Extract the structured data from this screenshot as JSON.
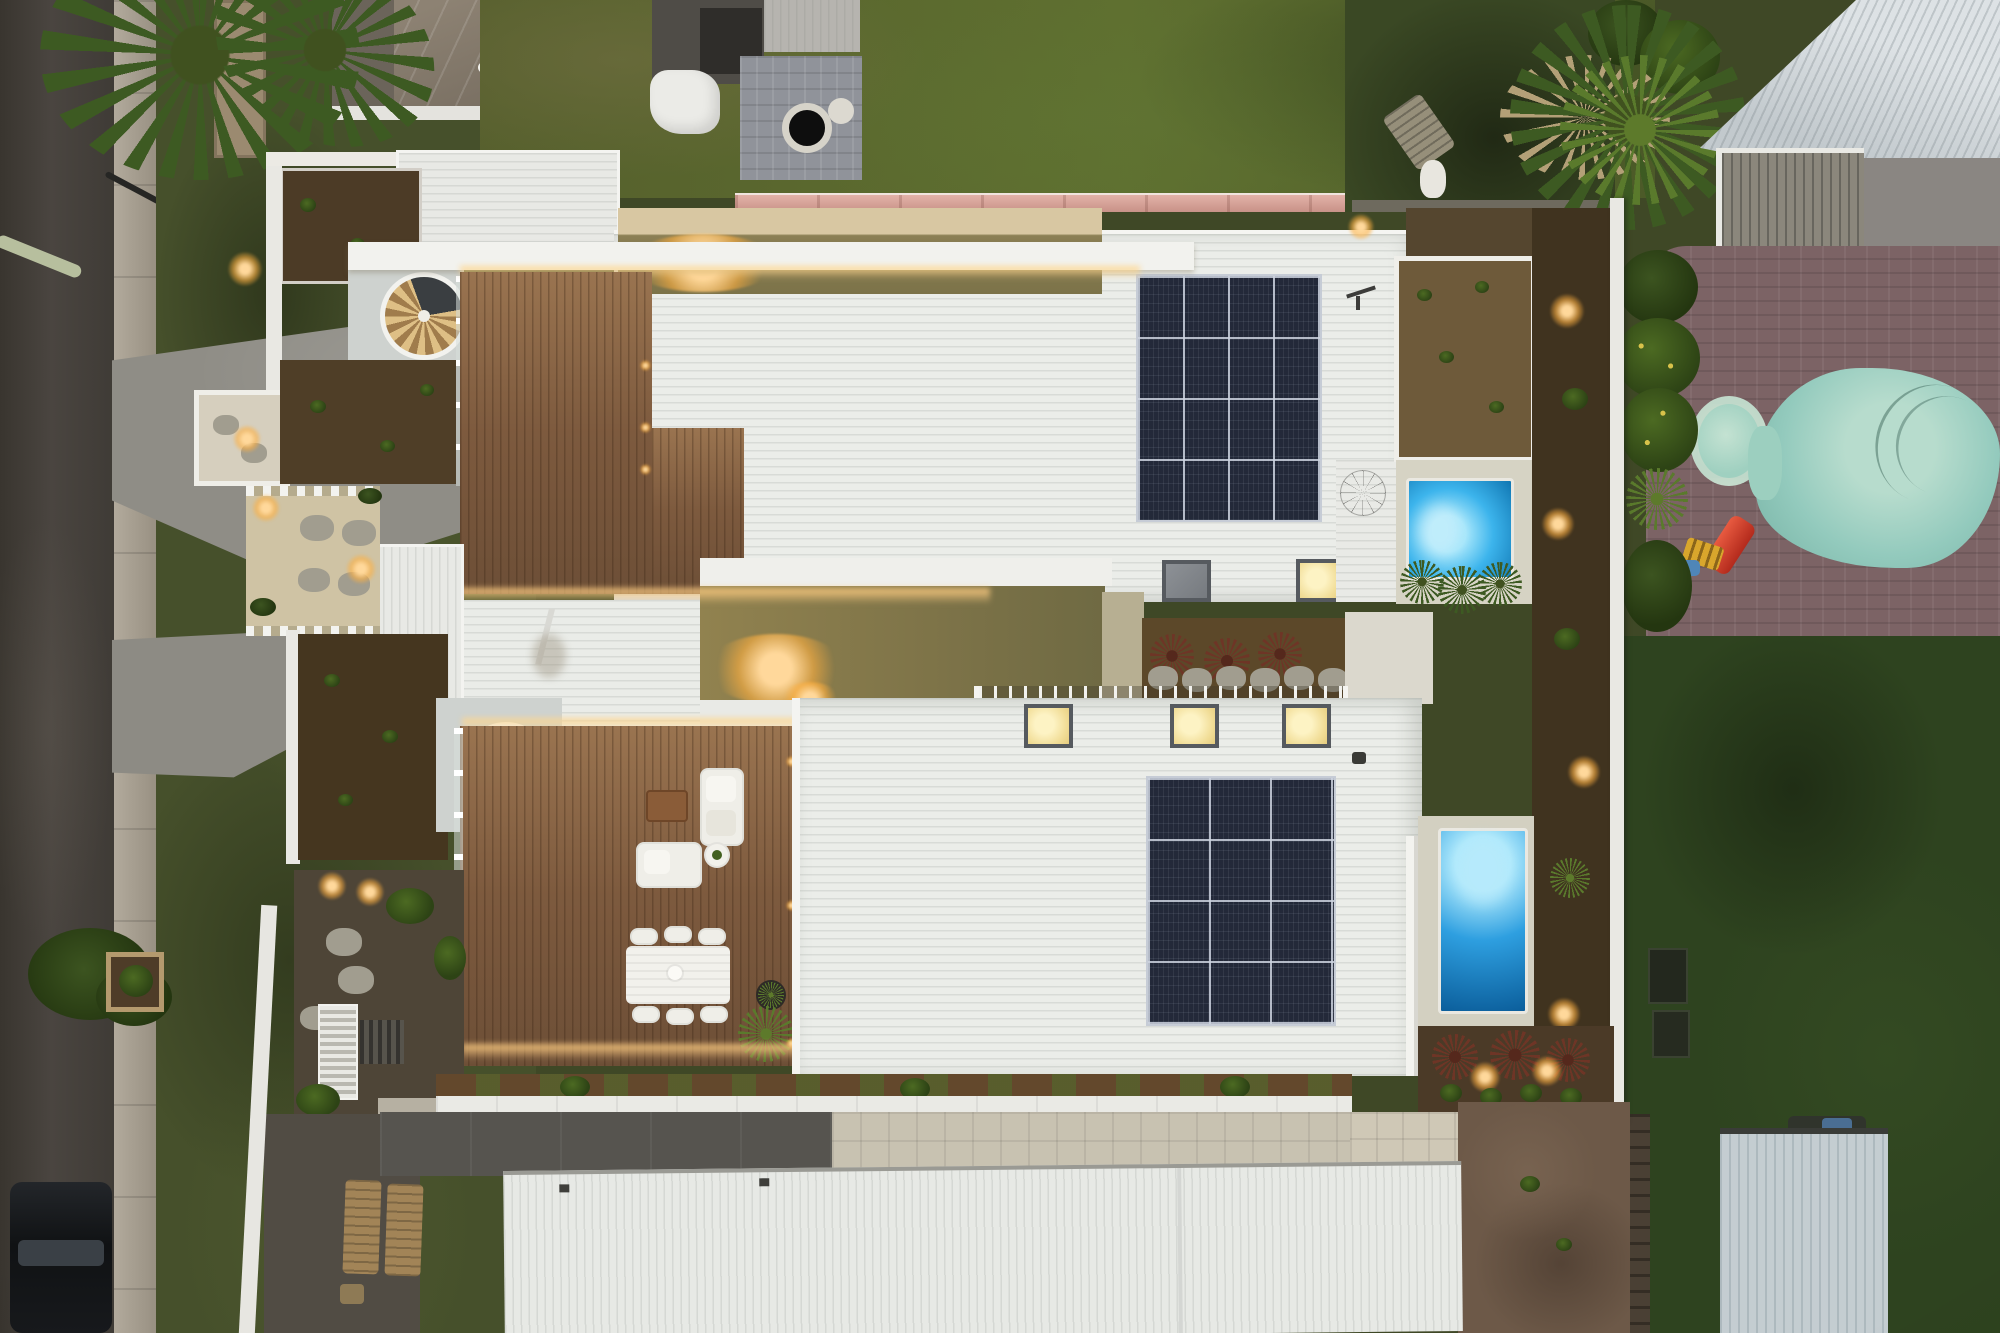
{
  "scene": {
    "type": "aerial-photograph",
    "setting": "top-down drone photo of a modern two-unit duplex at dusk",
    "time_of_day": "dusk with exterior lighting on",
    "no_visible_text": true,
    "title": "Aerial dusk view of duplex with rooftop decks, plunge pools and solar panels"
  },
  "palette": {
    "asphalt": "#45403a",
    "concrete": "#8f8d86",
    "grass_dark": "#3c4726",
    "grass_bright": "#5f7030",
    "roof_white": "#ebede9",
    "deck_timber": "#7e5b40",
    "mulch": "#4a3a26",
    "led_warm": "#ffc87e",
    "solar_navy": "#232939",
    "pool_blue": "#2aa0e2",
    "neighbor_pool_teal": "#93cabd",
    "fence_pink": "#d8a79e"
  },
  "street": {
    "road": "asphalt street along the left edge",
    "curb": "concrete kerb strip",
    "parked_car": "black SUV parked at the kerb, bottom left",
    "street_lamp": "lamp arm over the verge",
    "driveway_count": 2
  },
  "duplex": {
    "description": "two mirrored units, white metal roofs, rooftop timber decks, spiral stairs, plunge pools, solar arrays",
    "unit_north": {
      "garage_roof": "white corrugated garage roof on the street side",
      "spiral_staircase": "white spiral stair with timber treads",
      "rooftop_deck": "timber deck with warm LED strip lighting, unfurnished",
      "solar_array": {
        "rows": 4,
        "columns": 4
      },
      "skylights": [
        {
          "state": "lit"
        },
        {
          "state": "unlit"
        },
        {
          "state": "lit"
        }
      ],
      "pool": "rectangular plunge pool glowing cyan",
      "clothesline": "rotary clothesline on the rear roof",
      "gardens": "mulched beds with young plants and warm uplights"
    },
    "unit_south": {
      "garage_roof": "white corrugated garage roof on the street side",
      "spiral_staircase": "white spiral stair with timber treads",
      "rooftop_deck": {
        "lounge_set": "two white outdoor sofas with timber coffee table and round side table",
        "dining_set": "white dining table with six wicker chairs",
        "potted_plants": 2
      },
      "solar_array": {
        "rows": 4,
        "columns": 3
      },
      "skylights": [
        {
          "state": "lit"
        },
        {
          "state": "lit"
        },
        {
          "state": "lit"
        }
      ],
      "pool": "rectangular plunge pool glowing blue",
      "alfresco": "louvred screen, stepping stones, timber sun loungers, garden hose"
    },
    "shared": {
      "central_courtyard": "warm-lit concrete courtyard between the units",
      "pergola": "white slatted pergola over the rear patio",
      "garden_bed": "mulch bed with red cordylines and oval stepping stones",
      "hedge": "young hedge row along the southern wall",
      "front_garage_building": "long white corrugated roof across the street frontage",
      "boundary_fence": "white side boundary fence"
    }
  },
  "neighbors": {
    "north_west": "brown hip-roof house with white eaves and awnings",
    "north": "backyard with grey sheds, paved fire-pit patio and lawn",
    "north_boundary_fence": "pink-capped rear fence",
    "north_east": "white corrugated roof house with slatted pergola and tall palm",
    "east": "kidney-shaped teal pool with round spa, brick paving, red kids slide and ladder toy",
    "south_east": "dark lawn, timber fence, grey corrugated shed and bare dirt patch",
    "lighting": "warm landscape uplights throughout the gardens"
  }
}
